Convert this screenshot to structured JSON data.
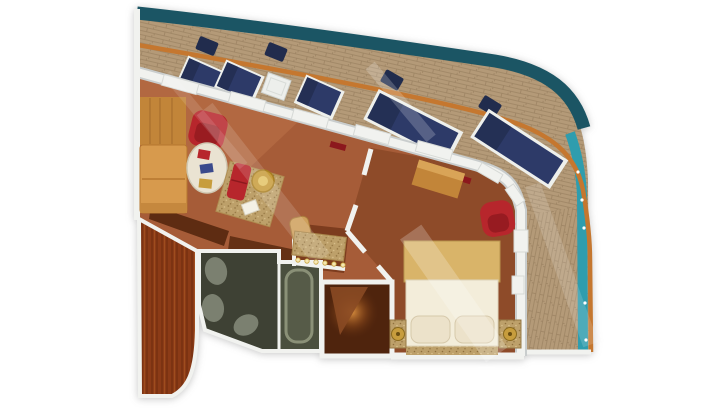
{
  "page": {
    "background": "#ffffff"
  },
  "plan": {
    "type": "cruise-ship-suite-floorplan",
    "rooms": [
      "balcony",
      "living-room",
      "dressing-area",
      "bedroom",
      "bathroom",
      "entry-foyer",
      "wardrobe-corridor"
    ],
    "furniture": {
      "balcony": [
        "chaise-lounge x5",
        "deck-chair x4",
        "side-table x1"
      ],
      "living_room": [
        "storage-cabinet",
        "sectional-sofa",
        "armchair",
        "coffee-table",
        "magazines",
        "area-rug",
        "ottoman-bench",
        "round-side-table",
        "paper-item"
      ],
      "dressing_area": [
        "vanity-counter",
        "vanity-lights",
        "vanity-stool"
      ],
      "bedroom": [
        "dresser",
        "double-bed",
        "pillow x2",
        "nightstand x2",
        "table-lamp x2",
        "armchair",
        "bed-runner"
      ],
      "bathroom": [
        "toilet",
        "bidet",
        "washbasin",
        "bathtub"
      ],
      "entry_foyer": [
        "door-leaf",
        "ceiling-light-glow"
      ]
    },
    "colors": {
      "hull": "#1b5564",
      "rail": "#c5772f",
      "glass": "#2f9dae",
      "deck": "#b49a78",
      "deck_line": "#9c8363",
      "wall": "#f1f2ef",
      "wall_shadow": "#c9cdcd",
      "living_floor": "#a65c38",
      "living_floor_light": "#c97f52",
      "bedroom_floor": "#8e4b29",
      "nook_floor": "#7c3c1e",
      "divider_wall": "#5e2c12",
      "foyer_floor": "#4f240d",
      "foyer_door": "#8a4a24",
      "corridor_wood": "#8b3b17",
      "bath_floor": "#3e4134",
      "bath_tub_zone": "#4a4f3e",
      "bath_fixture": "#7b8070",
      "tub_fill": "#565b48",
      "tub_rim": "#8a9077",
      "sofa": "#d79a4d",
      "sofa_trim": "#b5762f",
      "cabinet": "#c28539",
      "accent_red": "#b7262c",
      "accent_red_dark": "#8c181d",
      "table_white": "#edefec",
      "coffee_table": "#eae3d2",
      "gold": "#c79d3d",
      "gold_light": "#e3c468",
      "bed_headboard": "#d9b469",
      "bed_duvet": "#f3edda",
      "bed_pillow": "#ece2ca",
      "lounger": "#2d3a68",
      "lounger_dark": "#212c4d",
      "bulb": "#f6e7b0"
    }
  }
}
